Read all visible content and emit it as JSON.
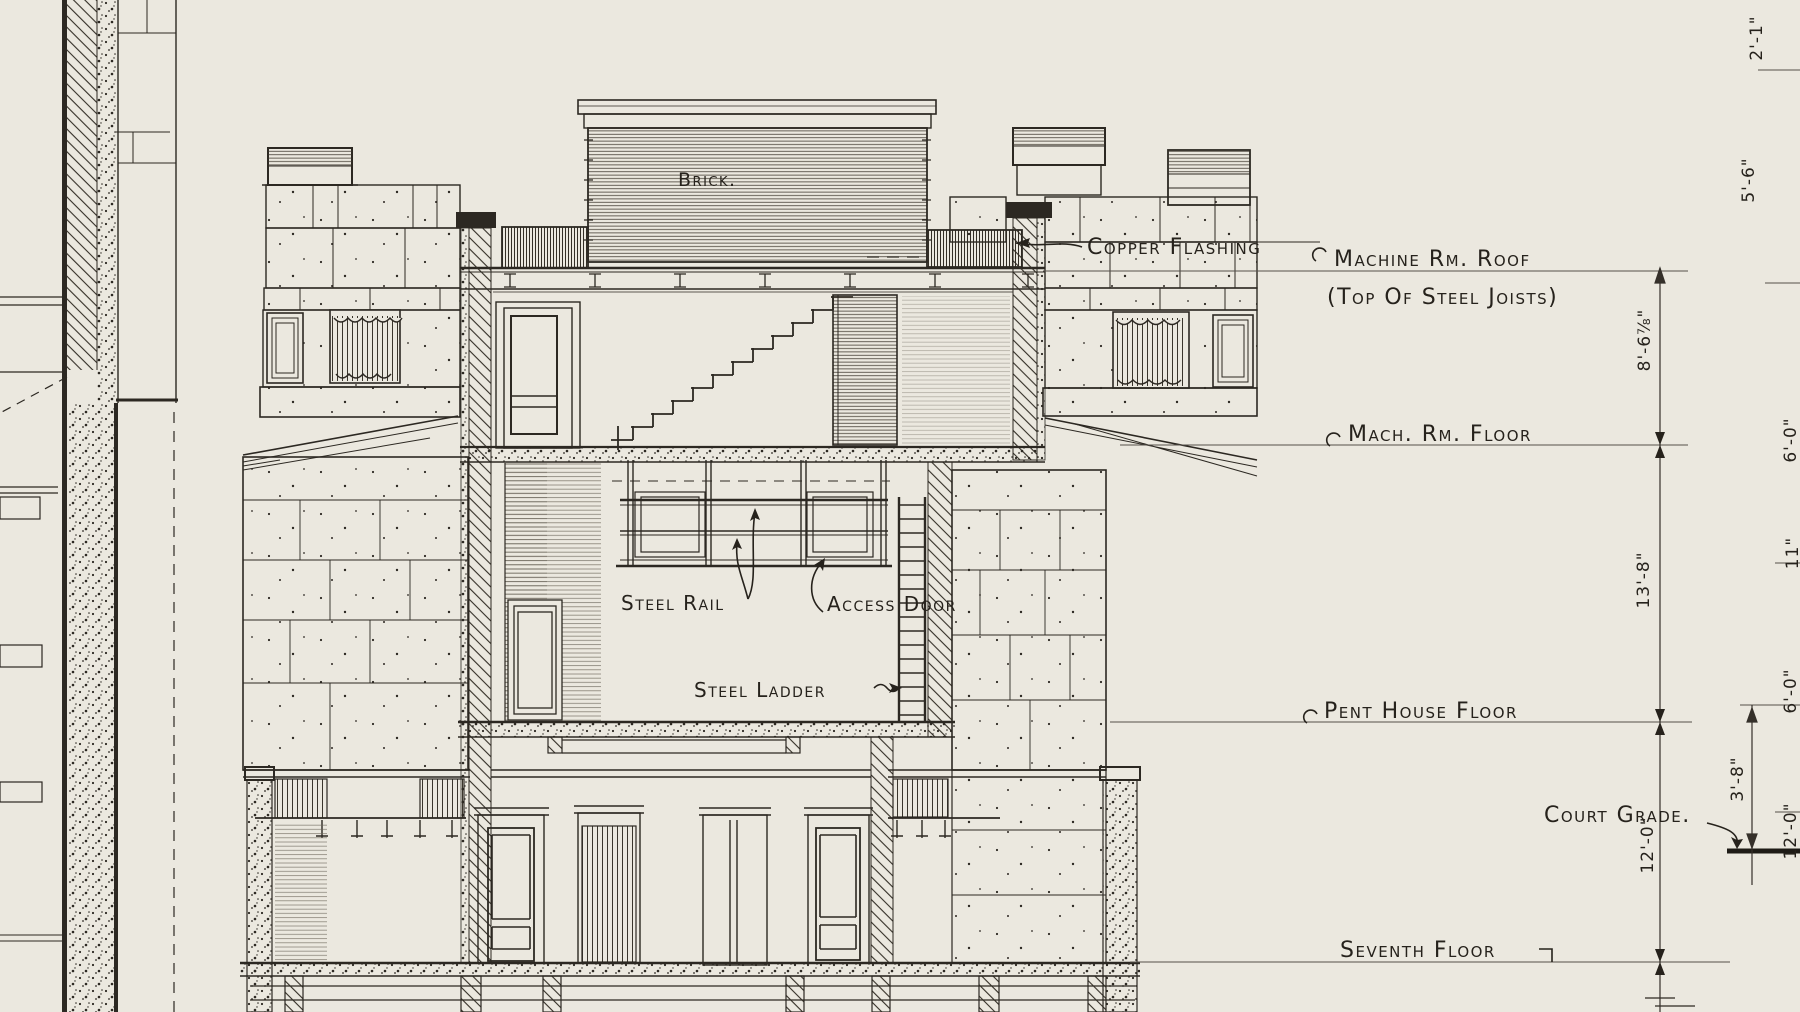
{
  "drawing": {
    "title_context": "building section detail",
    "annotations": {
      "brick": "Brick.",
      "copper_flashing": "Copper Flashing",
      "machine_rm_roof": "Machine Rm. Roof",
      "machine_rm_roof_sub": "(Top Of Steel Joists)",
      "mach_rm_floor": "Mach. Rm. Floor",
      "steel_rail": "Steel Rail",
      "access_door": "Access Door",
      "steel_ladder": "Steel Ladder",
      "pent_house_floor": "Pent House Floor",
      "court_grade": "Court Grade.",
      "seventh_floor": "Seventh Floor"
    },
    "dimensions": {
      "roof_to_mach_floor": "8'-6⅞\"",
      "mach_floor_to_pent_floor": "13'-8\"",
      "pent_floor_to_seventh": "12'-0\"",
      "pent_floor_to_court_grade": "3'-8\"",
      "edge_top": "2'-1\"",
      "edge_upper": "5'-6\"",
      "edge_mid_a": "6'-0\"",
      "edge_mid_b": "11\"",
      "edge_mid_c": "6'-0\"",
      "edge_lower": "12'-0\""
    },
    "colors": {
      "paper": "#ebe8df",
      "ink": "#2c2822",
      "light_ink": "#6b655a"
    }
  }
}
